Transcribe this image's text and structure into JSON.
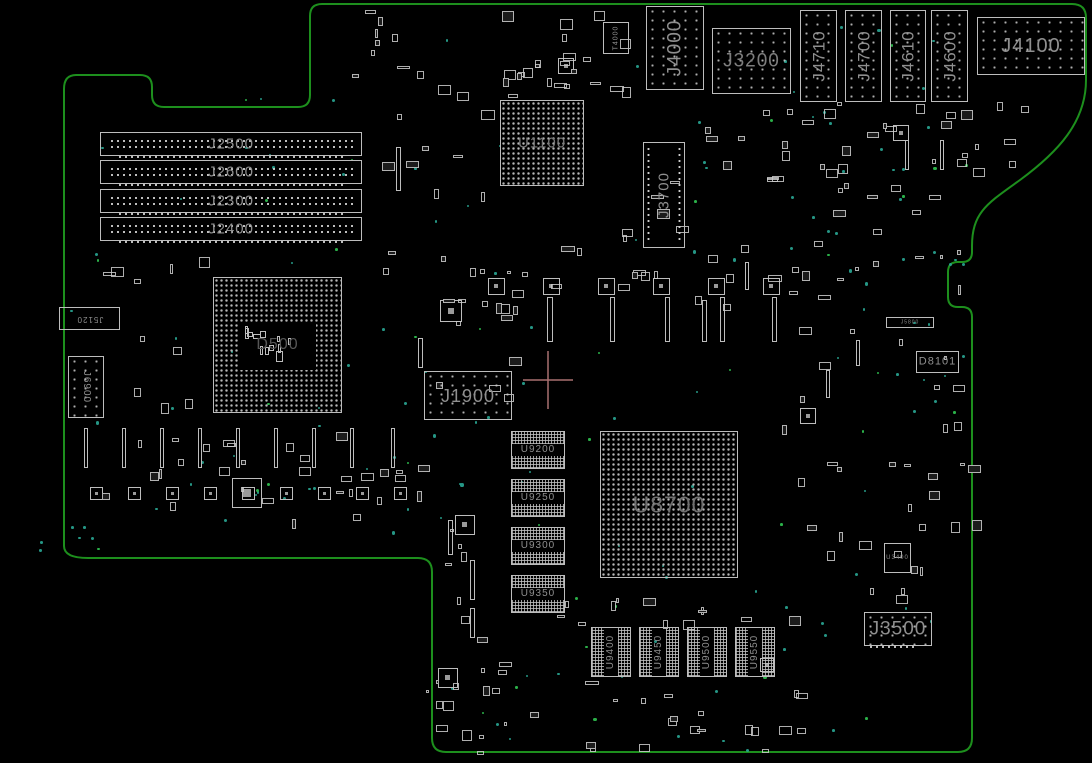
{
  "app": {
    "type": "pcb-boardview-canvas",
    "description": "Logic board top-side boardview rendering"
  },
  "colors": {
    "background": "#000000",
    "board_outline": "#1d8f1d",
    "component_stroke": "#bdbdbd",
    "label": "#8f8f8f",
    "label_dim": "#6e6e6e",
    "label_faint": "#565656",
    "via_teal": "#28a390",
    "via_green": "#2fbf4f",
    "crosshair": "#a97070"
  },
  "crosshair": {
    "x": 548,
    "y": 380,
    "arm_h": 25,
    "arm_v": 29
  },
  "components": [
    {
      "id": "J2500",
      "label": "J2500",
      "type": "dimm",
      "x": 100,
      "y": 132,
      "w": 262,
      "h": 24,
      "font": 15
    },
    {
      "id": "J2600",
      "label": "J2600",
      "type": "dimm",
      "x": 100,
      "y": 160,
      "w": 262,
      "h": 24,
      "font": 15
    },
    {
      "id": "J2300",
      "label": "J2300",
      "type": "dimm",
      "x": 100,
      "y": 189,
      "w": 262,
      "h": 24,
      "font": 15
    },
    {
      "id": "J2400",
      "label": "J2400",
      "type": "dimm",
      "x": 100,
      "y": 217,
      "w": 262,
      "h": 24,
      "font": 15
    },
    {
      "id": "U1100",
      "label": "U1100",
      "type": "bga",
      "x": 500,
      "y": 100,
      "w": 84,
      "h": 86,
      "font": 15,
      "lcolor": "#787878"
    },
    {
      "id": "T4000",
      "label": "T4000",
      "type": "box",
      "x": 603,
      "y": 22,
      "w": 26,
      "h": 32,
      "font": 7,
      "rot": "rm90"
    },
    {
      "id": "J4000",
      "label": "J4000",
      "type": "conn",
      "x": 646,
      "y": 6,
      "w": 58,
      "h": 84,
      "font": 19,
      "rot": "rm90"
    },
    {
      "id": "J3200",
      "label": "J3200",
      "type": "conn",
      "x": 712,
      "y": 28,
      "w": 79,
      "h": 66,
      "font": 19,
      "lcolor": "#7d7d7d"
    },
    {
      "id": "J4710",
      "label": "J4710",
      "type": "conn",
      "x": 800,
      "y": 10,
      "w": 37,
      "h": 92,
      "font": 17,
      "rot": "rm90"
    },
    {
      "id": "J4700",
      "label": "J4700",
      "type": "conn",
      "x": 845,
      "y": 10,
      "w": 37,
      "h": 92,
      "font": 17,
      "rot": "rm90"
    },
    {
      "id": "J4610",
      "label": "J4610",
      "type": "conn",
      "x": 890,
      "y": 10,
      "w": 36,
      "h": 92,
      "font": 17,
      "rot": "rm90"
    },
    {
      "id": "J4600",
      "label": "J4600",
      "type": "conn",
      "x": 931,
      "y": 10,
      "w": 37,
      "h": 92,
      "font": 17,
      "rot": "rm90"
    },
    {
      "id": "J4100",
      "label": "J4100",
      "type": "conn",
      "x": 977,
      "y": 17,
      "w": 108,
      "h": 58,
      "font": 20
    },
    {
      "id": "J3700",
      "label": "J3700",
      "type": "pinbox",
      "x": 643,
      "y": 142,
      "w": 42,
      "h": 106,
      "font": 15,
      "rot": "rm90"
    },
    {
      "id": "D500",
      "label": "D500",
      "type": "socket",
      "x": 213,
      "y": 277,
      "w": 129,
      "h": 136,
      "font": 16
    },
    {
      "id": "J5120",
      "label": "J5120",
      "type": "box",
      "x": 59,
      "y": 307,
      "w": 61,
      "h": 23,
      "font": 8,
      "rot": "r180"
    },
    {
      "id": "J6900",
      "label": "J6900",
      "type": "conn",
      "x": 68,
      "y": 356,
      "w": 36,
      "h": 62,
      "font": 10,
      "rot": "r90"
    },
    {
      "id": "J1900",
      "label": "J1900",
      "type": "conn",
      "x": 424,
      "y": 371,
      "w": 88,
      "h": 49,
      "font": 18
    },
    {
      "id": "J5800",
      "label": "J5800",
      "type": "box",
      "x": 886,
      "y": 317,
      "w": 48,
      "h": 11,
      "font": 5
    },
    {
      "id": "D8101",
      "label": "D8101",
      "type": "box",
      "x": 916,
      "y": 351,
      "w": 43,
      "h": 22,
      "font": 11
    },
    {
      "id": "U8700",
      "label": "U8700",
      "type": "bga",
      "x": 600,
      "y": 431,
      "w": 138,
      "h": 147,
      "font": 23,
      "lcolor": "#6f6f6f"
    },
    {
      "id": "U9200",
      "label": "U9200",
      "type": "band-h",
      "x": 511,
      "y": 431,
      "w": 54,
      "h": 38,
      "font": 10
    },
    {
      "id": "U9250",
      "label": "U9250",
      "type": "band-h",
      "x": 511,
      "y": 479,
      "w": 54,
      "h": 38,
      "font": 10
    },
    {
      "id": "U9300",
      "label": "U9300",
      "type": "band-h",
      "x": 511,
      "y": 527,
      "w": 54,
      "h": 38,
      "font": 10
    },
    {
      "id": "U9350",
      "label": "U9350",
      "type": "band-h",
      "x": 511,
      "y": 575,
      "w": 54,
      "h": 38,
      "font": 10
    },
    {
      "id": "U9400",
      "label": "U9400",
      "type": "band-v",
      "x": 591,
      "y": 627,
      "w": 40,
      "h": 50,
      "font": 10,
      "rot": "rm90"
    },
    {
      "id": "U9450",
      "label": "U9450",
      "type": "band-v",
      "x": 639,
      "y": 627,
      "w": 40,
      "h": 50,
      "font": 10,
      "rot": "rm90"
    },
    {
      "id": "U9500",
      "label": "U9500",
      "type": "band-v",
      "x": 687,
      "y": 627,
      "w": 40,
      "h": 50,
      "font": 10,
      "rot": "rm90"
    },
    {
      "id": "U9550",
      "label": "U9550",
      "type": "band-v",
      "x": 735,
      "y": 627,
      "w": 40,
      "h": 50,
      "font": 10,
      "rot": "rm90"
    },
    {
      "id": "U3400",
      "label": "U3400",
      "type": "box",
      "x": 884,
      "y": 543,
      "w": 27,
      "h": 30,
      "font": 6
    },
    {
      "id": "J3500",
      "label": "J3500",
      "type": "hconn",
      "x": 864,
      "y": 612,
      "w": 68,
      "h": 34,
      "font": 19
    }
  ],
  "decoration": {
    "seed": 13,
    "bars": [
      [
        396,
        147,
        5,
        44
      ],
      [
        418,
        338,
        5,
        30
      ],
      [
        547,
        297,
        6,
        45
      ],
      [
        610,
        297,
        5,
        45
      ],
      [
        665,
        297,
        5,
        45
      ],
      [
        720,
        297,
        5,
        45
      ],
      [
        772,
        297,
        5,
        45
      ],
      [
        84,
        428,
        4,
        40
      ],
      [
        122,
        428,
        4,
        40
      ],
      [
        160,
        428,
        4,
        40
      ],
      [
        198,
        428,
        4,
        40
      ],
      [
        236,
        428,
        4,
        40
      ],
      [
        274,
        428,
        4,
        40
      ],
      [
        312,
        428,
        4,
        40
      ],
      [
        350,
        428,
        4,
        40
      ],
      [
        391,
        428,
        4,
        40
      ],
      [
        470,
        560,
        5,
        40
      ],
      [
        470,
        608,
        5,
        30
      ],
      [
        448,
        520,
        5,
        35
      ],
      [
        905,
        140,
        4,
        30
      ],
      [
        940,
        140,
        4,
        30
      ],
      [
        702,
        300,
        5,
        42
      ],
      [
        745,
        262,
        4,
        28
      ],
      [
        826,
        370,
        4,
        28
      ],
      [
        856,
        340,
        4,
        26
      ]
    ],
    "squares": [
      [
        488,
        278,
        17
      ],
      [
        543,
        278,
        17
      ],
      [
        598,
        278,
        17
      ],
      [
        653,
        278,
        17
      ],
      [
        708,
        278,
        17
      ],
      [
        763,
        278,
        17
      ],
      [
        90,
        487,
        13
      ],
      [
        128,
        487,
        13
      ],
      [
        166,
        487,
        13
      ],
      [
        204,
        487,
        13
      ],
      [
        242,
        487,
        13
      ],
      [
        280,
        487,
        13
      ],
      [
        318,
        487,
        13
      ],
      [
        356,
        487,
        13
      ],
      [
        394,
        487,
        13
      ],
      [
        232,
        478,
        30
      ],
      [
        440,
        300,
        22
      ],
      [
        455,
        515,
        20
      ],
      [
        438,
        668,
        20
      ],
      [
        558,
        58,
        16
      ],
      [
        760,
        658,
        14
      ],
      [
        800,
        408,
        16
      ],
      [
        893,
        125,
        16
      ]
    ],
    "smd_zones": [
      [
        330,
        8,
        300,
        85,
        26
      ],
      [
        500,
        55,
        120,
        40,
        8
      ],
      [
        370,
        95,
        115,
        180,
        12
      ],
      [
        455,
        245,
        350,
        60,
        24
      ],
      [
        700,
        95,
        105,
        85,
        12
      ],
      [
        812,
        100,
        150,
        165,
        24
      ],
      [
        955,
        100,
        75,
        70,
        9
      ],
      [
        70,
        245,
        135,
        180,
        10
      ],
      [
        75,
        425,
        345,
        100,
        30
      ],
      [
        425,
        285,
        95,
        110,
        9
      ],
      [
        430,
        480,
        70,
        225,
        12
      ],
      [
        555,
        595,
        235,
        28,
        12
      ],
      [
        425,
        655,
        170,
        100,
        14
      ],
      [
        590,
        688,
        210,
        62,
        16
      ],
      [
        778,
        420,
        195,
        180,
        16
      ],
      [
        788,
        250,
        175,
        155,
        14
      ],
      [
        855,
        440,
        115,
        155,
        10
      ],
      [
        620,
        180,
        60,
        60,
        6
      ]
    ],
    "dot_zones": [
      [
        430,
        10,
        540,
        540,
        55
      ],
      [
        70,
        85,
        355,
        455,
        35
      ],
      [
        70,
        440,
        360,
        110,
        15
      ],
      [
        430,
        560,
        540,
        190,
        30
      ],
      [
        790,
        60,
        185,
        370,
        25
      ],
      [
        35,
        525,
        60,
        25,
        4
      ]
    ]
  }
}
